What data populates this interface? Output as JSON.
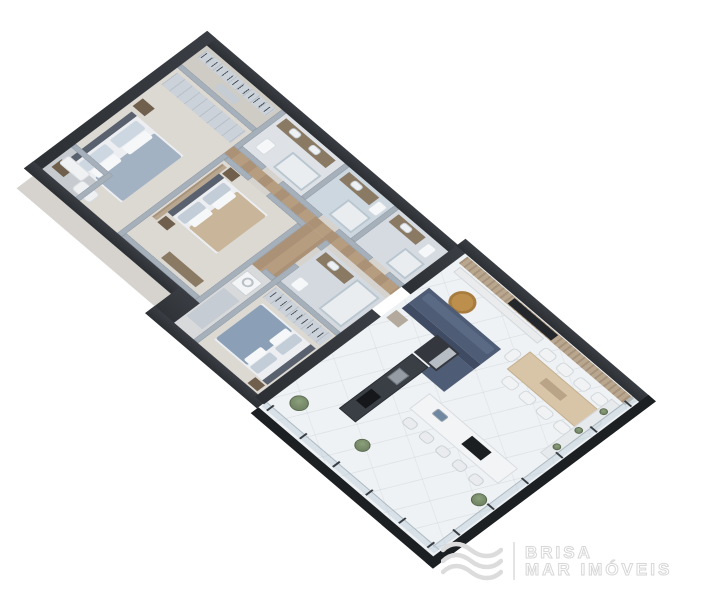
{
  "meta": {
    "canvas": {
      "width": 725,
      "height": 600
    },
    "background": "#ffffff",
    "scene": "isometric 3D apartment floor plan render, white background"
  },
  "logo": {
    "icon": "waves-icon",
    "line1": "BRISA",
    "line2": "MAR IMÓVEIS",
    "color": "#d7d7d7"
  },
  "palette": {
    "exterior_wall": "#33373c",
    "slab_edge": "#1d2023",
    "interior_wall": "#a6b0bb",
    "wood_floor": "#b79d80",
    "marble_floor": "#eff2f4",
    "bedroom_floor": "#dcd8d2",
    "bath_floor": "#ccd7e0",
    "sofa_navy": "#4e5c76",
    "coffee_table_gold": "#bd8f4d",
    "wood_slat_wall": "#b3a18c",
    "dining_table_wood": "#d8c5a8",
    "beige_blanket": "#c9b69a",
    "blue_blanket": "#8ba0b6",
    "glass_railing": "#bbcdd8",
    "plant_green": "#7c8f6e",
    "kitchen_dark": "#3a3f45"
  },
  "floor_plan": {
    "type": "isometric-3d-floor-plan",
    "orientation": "long axis runs top-left to bottom-right",
    "totals": {
      "bedrooms": 3,
      "bathrooms": 4,
      "dining_chairs": 10,
      "bar_stools": 5,
      "plants": 5
    },
    "rooms": [
      {
        "id": "walk-in-closet",
        "name": "Walk-in closet",
        "furniture": [
          "hanging rail with clothes",
          "dresser island"
        ]
      },
      {
        "id": "bathroom-1",
        "name": "Bathroom 1",
        "furniture": [
          "double vanity with two sinks",
          "shower",
          "toilet"
        ]
      },
      {
        "id": "bathroom-2",
        "name": "Bathroom 2",
        "furniture": [
          "vanity",
          "shower",
          "toilet"
        ]
      },
      {
        "id": "bathroom-3",
        "name": "Bathroom 3 (WC)",
        "furniture": [
          "vanity",
          "shower",
          "toilet"
        ]
      },
      {
        "id": "master-bedroom",
        "name": "Master bedroom",
        "furniture": [
          "double bed with blue-gray bedding",
          "wardrobe run",
          "2 nightstands",
          "armchair"
        ]
      },
      {
        "id": "master-balcony",
        "name": "Master balcony",
        "furniture": [
          "lounge chair"
        ]
      },
      {
        "id": "bedroom-2",
        "name": "Bedroom 2",
        "furniture": [
          "double bed with beige blanket",
          "wood slat accent wall",
          "2 nightstands",
          "dresser"
        ]
      },
      {
        "id": "ensuite-bathroom",
        "name": "Ensuite bathroom",
        "furniture": [
          "vanity",
          "shower",
          "toilet"
        ]
      },
      {
        "id": "bedroom-3",
        "name": "Bedroom 3",
        "furniture": [
          "double bed with blue blanket",
          "wardrobe with hanging clothes",
          "nightstand"
        ]
      },
      {
        "id": "laundry",
        "name": "Laundry / service",
        "furniture": [
          "washing machine",
          "counter"
        ]
      },
      {
        "id": "hallway",
        "name": "Hallway",
        "furniture": [
          "wood plank floor"
        ]
      },
      {
        "id": "open-living",
        "name": "Open living / dining / kitchen with terrace",
        "furniture": [
          "navy L-shaped sectional sofa",
          "round gold coffee table",
          "wood-slat TV wall with TV",
          "white media console",
          "wood dining table with 10 white chairs",
          "dark kitchen cabinetry with fridge, sink and cooktop",
          "white bar island with sink, cooktop and 5 stools",
          "glass balustrade with posts",
          "potted plants",
          "planter bench"
        ]
      }
    ]
  }
}
